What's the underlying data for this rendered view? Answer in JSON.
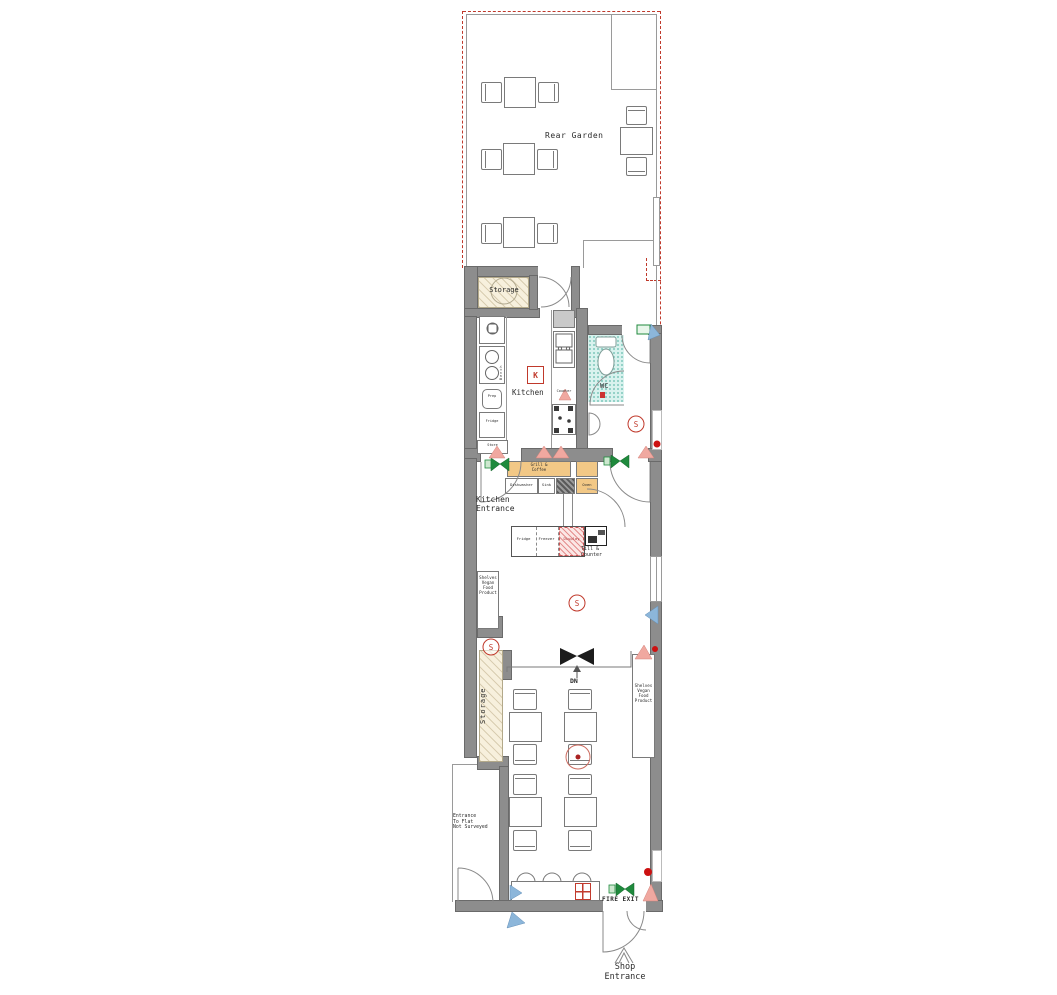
{
  "colors": {
    "boundary_red": "#c0392b",
    "wall_gray": "#8d8d8d",
    "counter_tan": "#f2c886",
    "storage_cream": "#f7f0dd",
    "wc_teal": "#d9f2ee",
    "symbol_green": "#1f8a3d",
    "symbol_blue": "#8cb6da",
    "symbol_pink": "#f0a8a0",
    "symbol_red": "#cc1111"
  },
  "labels": {
    "rear_garden": "Rear Garden",
    "storage_room": "Storage",
    "kitchen_tag": "K",
    "kitchen": "Kitchen",
    "wc": "WC",
    "detector": "S",
    "kitchen_entrance": "Kitchen\nEntrance",
    "till_counter": "Till &\nCounter",
    "shelves_left": "Shelves\nVegan\nFood\nProduct",
    "shelves_right": "Shelves\nVegan\nFood\nProduct",
    "storage_strip": "Storage",
    "stairs_down": "DN",
    "fire_exit": "FIRE EXIT",
    "shop_entrance": "Shop\nEntrance",
    "flat_note": "Entrance\nTo Flat\nNot Surveyed"
  },
  "equipment": {
    "grill_counter": "Grill &\nCoffee",
    "dishwasher": "Dishwasher",
    "sink": "Sink",
    "oven": "Oven",
    "prep": "Prep",
    "fridge_small": "Fridge",
    "store": "Store",
    "bench": "Bench",
    "counter_small": "Counter",
    "fridge": "Fridge",
    "freezer": "Freezer",
    "display": "Display"
  }
}
